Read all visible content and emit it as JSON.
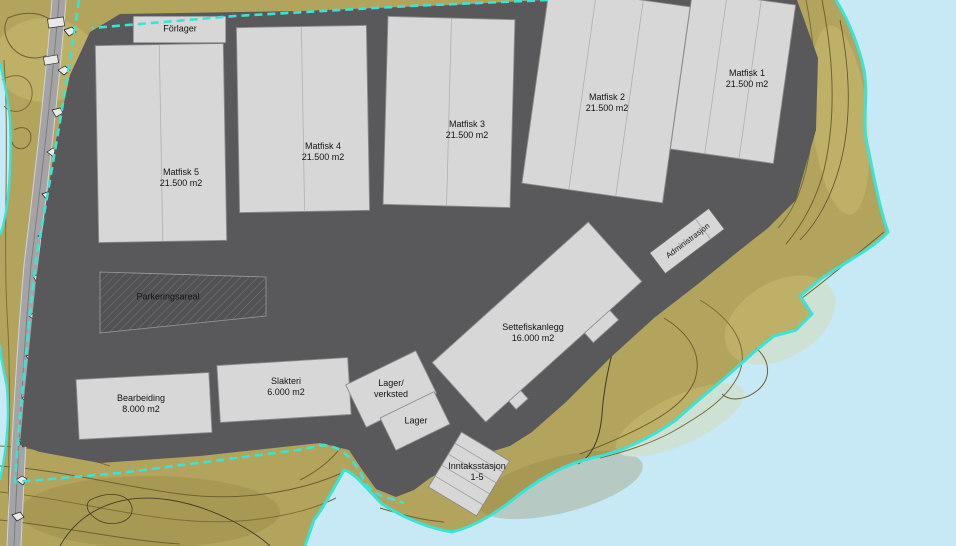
{
  "colors": {
    "water": "#c7e8f5",
    "terrain": "#b2a45c",
    "platform": "#59595b",
    "building_fill": "#d7d7d8",
    "building_stroke": "#8c8c8e",
    "shoreline": "#3be3d4",
    "boundary": "#3be3d4",
    "contour": "#7c6d38",
    "parking_fill": "#525254",
    "road": "#a4a4a6"
  },
  "buildings": {
    "forlager": {
      "name": "Förlager"
    },
    "matfisk5": {
      "name": "Matfisk 5",
      "area": "21.500 m2"
    },
    "matfisk4": {
      "name": "Matfisk 4",
      "area": "21.500 m2"
    },
    "matfisk3": {
      "name": "Matfisk 3",
      "area": "21.500 m2"
    },
    "matfisk2": {
      "name": "Matfisk 2",
      "area": "21.500 m2"
    },
    "matfisk1": {
      "name": "Matfisk 1",
      "area": "21.500 m2"
    },
    "administrasjon": {
      "name": "Administrasjon"
    },
    "settefiskanlegg": {
      "name": "Settefiskanlegg",
      "area": "16.000 m2"
    },
    "bearbeiding": {
      "name": "Bearbeiding",
      "area": "8.000 m2"
    },
    "slakteri": {
      "name": "Slakteri",
      "area": "6.000 m2"
    },
    "lager_verksted": {
      "line1": "Lager/",
      "line2": "verksted"
    },
    "lager": {
      "name": "Lager"
    },
    "inntaksstasjon": {
      "name": "Inntaksstasjon",
      "units": "1-5"
    }
  },
  "areas": {
    "parkeringsareal": {
      "name": "Parkeringsareal"
    }
  }
}
